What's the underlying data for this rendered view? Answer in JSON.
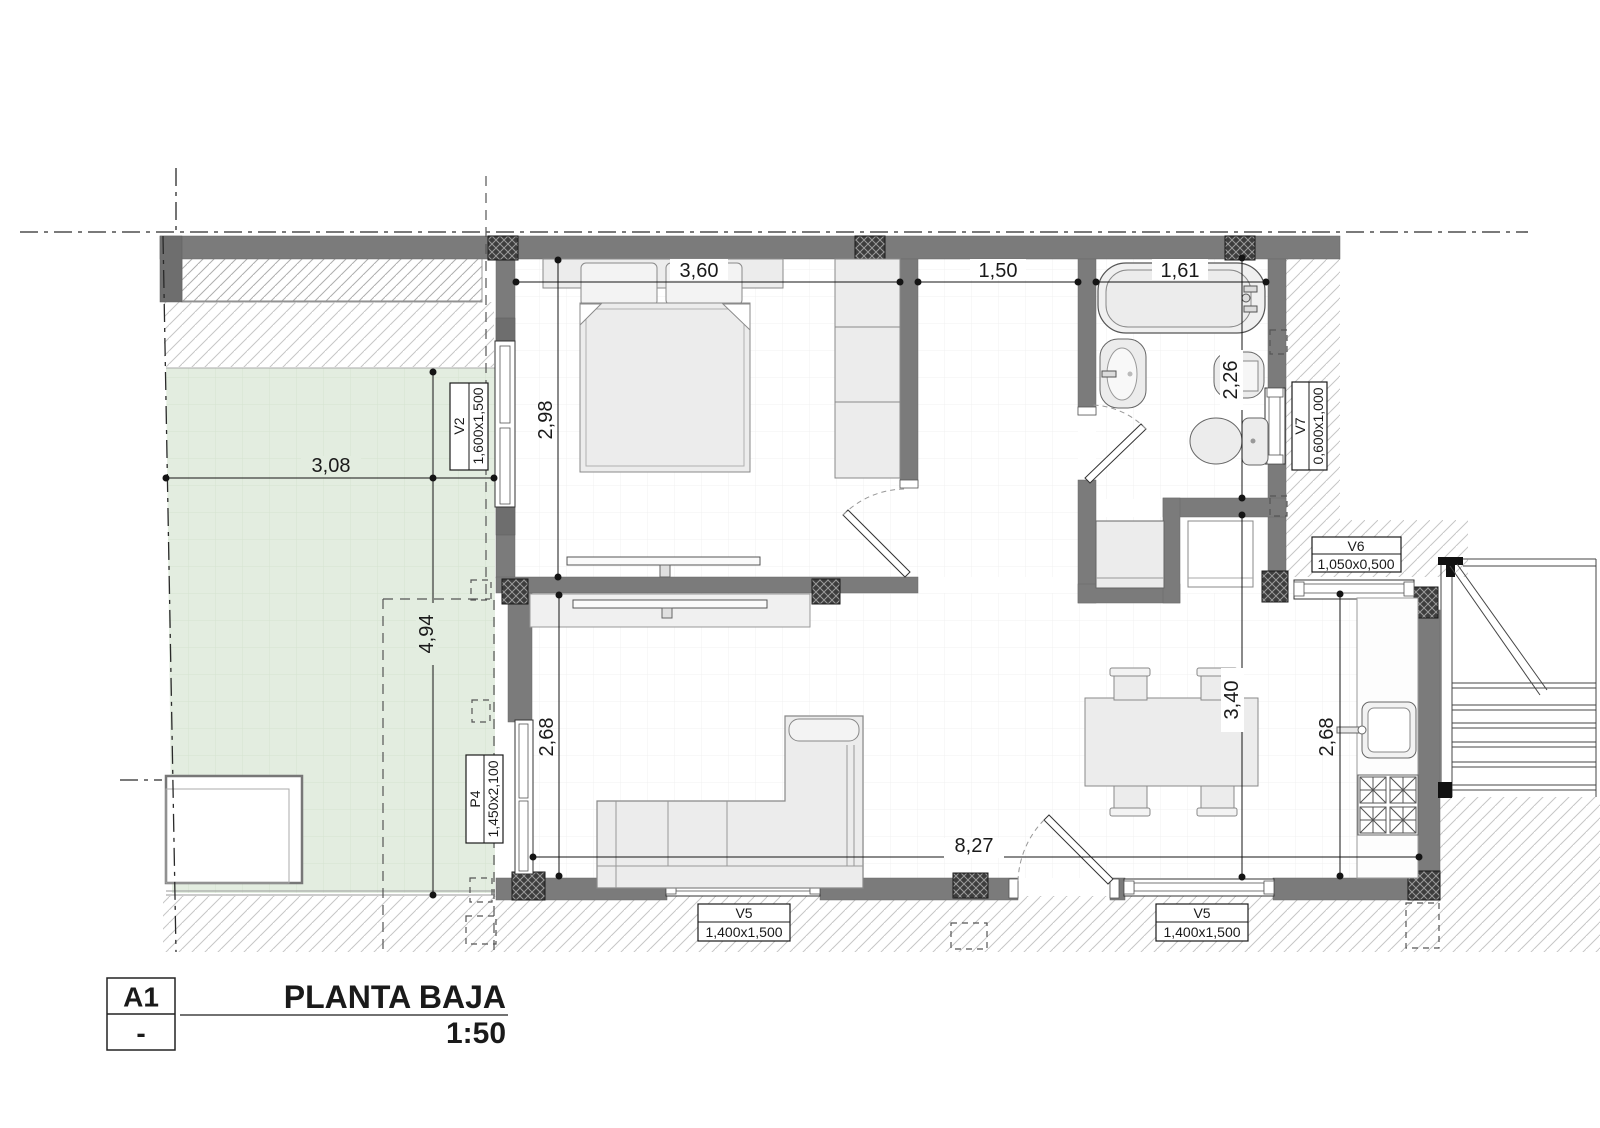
{
  "plan": {
    "dims": {
      "bedroom_width": "3,60",
      "hall_width": "1,50",
      "bath_width": "1,61",
      "bedroom_depth": "2,98",
      "bath_depth": "2,26",
      "terrace_width": "3,08",
      "terrace_depth": "4,94",
      "living_depth": "2,68",
      "kitchen_depth": "2,68",
      "dining_depth": "3,40",
      "overall_width": "8,27"
    },
    "openings": {
      "v2": {
        "code": "V2",
        "size": "1,600x1,500"
      },
      "p4": {
        "code": "P4",
        "size": "1,450x2,100"
      },
      "v5a": {
        "code": "V5",
        "size": "1,400x1,500"
      },
      "v5b": {
        "code": "V5",
        "size": "1,400x1,500"
      },
      "v6": {
        "code": "V6",
        "size": "1,050x0,500"
      },
      "v7": {
        "code": "V7",
        "size": "0,600x1,000"
      }
    },
    "title_block": {
      "sheet": "A1",
      "revision": "-",
      "title": "PLANTA BAJA",
      "scale": "1:50"
    },
    "colors": {
      "wall": "#7b7b7b",
      "pillar": "#3d3d3d",
      "terrace": "#e3ede0",
      "furniture": "#ececec",
      "hatch": "#c6c6c6",
      "dimension": "#141414"
    }
  }
}
